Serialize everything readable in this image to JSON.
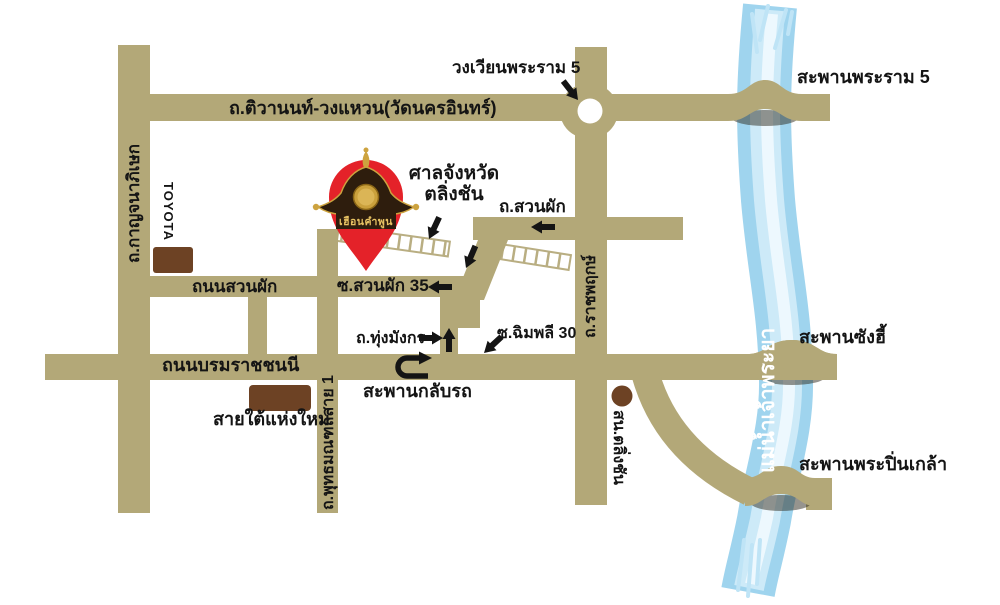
{
  "map_title": "แผนที่เส้นทาง เฮือนคำพูน ตลิ่งชัน",
  "logo": {
    "text": "เฮือนคำพูน"
  },
  "labels": {
    "wongwian_rama5": "วงเวียนพระราม 5",
    "saphan_rama5": "สะพานพระราม 5",
    "tiwanon": "ถ.ติวานนท์-วงแหวน(วัดนครอินทร์)",
    "kanchanaphisek": "ถ.กาญจนาภิเษก",
    "toyota": "TOYOTA",
    "court_line1": "ศาลจังหวัด",
    "court_line2": "ตลิ่งชัน",
    "suanphak": "ถ.สวนผัก",
    "thanon_suanphak": "ถนนสวนผัก",
    "soi_suanphak35": "ซ.สวนผัก 35",
    "thung_mangkon": "ถ.ทุ่งมังกร",
    "soi_chimphli30": "ซ.ฉิมพลี 30",
    "borommaratchachonnani": "ถนนบรมราชชนนี",
    "saphan_klap_rot": "สะพานกลับรถ",
    "sai_tai": "สายใต้แห่งใหม่",
    "phutthamonthon1": "ถ.พุทธมณฑลสาย 1",
    "ratchaphruek": "ถ.ราชพฤกษ์",
    "sn_taling_chan": "สน.ตลิ่งชัน",
    "saphan_sang_hi": "สะพานซังฮี้",
    "saphan_pinklao": "สะพานพระปิ่นเกล้า",
    "river": "แม่น้ำเจ้าพระยา"
  },
  "colors": {
    "road": "#b3a878",
    "rail_outline": "#b9ae82",
    "river_base": "#9fd4ee",
    "river_light": "#cdeaf8",
    "river_highlight": "#edf8fe",
    "pin_red": "#e42229",
    "logo_roof": "#2e1d0d",
    "logo_gold": "#cda33f",
    "building_brown": "#6d4224",
    "text": "#141414"
  },
  "icons": {
    "location_pin": "location-pin-icon (red map pin with Thai roof logo)",
    "u_turn": "u-turn-arrow-icon",
    "roundabout": "roundabout-white-circle",
    "railway": "railway-crossing-ladder",
    "arrows": [
      "left-arrow-icon",
      "right-arrow-icon",
      "up-arrow-icon",
      "down-left-arrow-icon",
      "down-right-arrow-icon"
    ],
    "police_station": "brown-dot-marker",
    "buildings": [
      "toyota-building-block",
      "southern-bus-terminal-block"
    ]
  }
}
